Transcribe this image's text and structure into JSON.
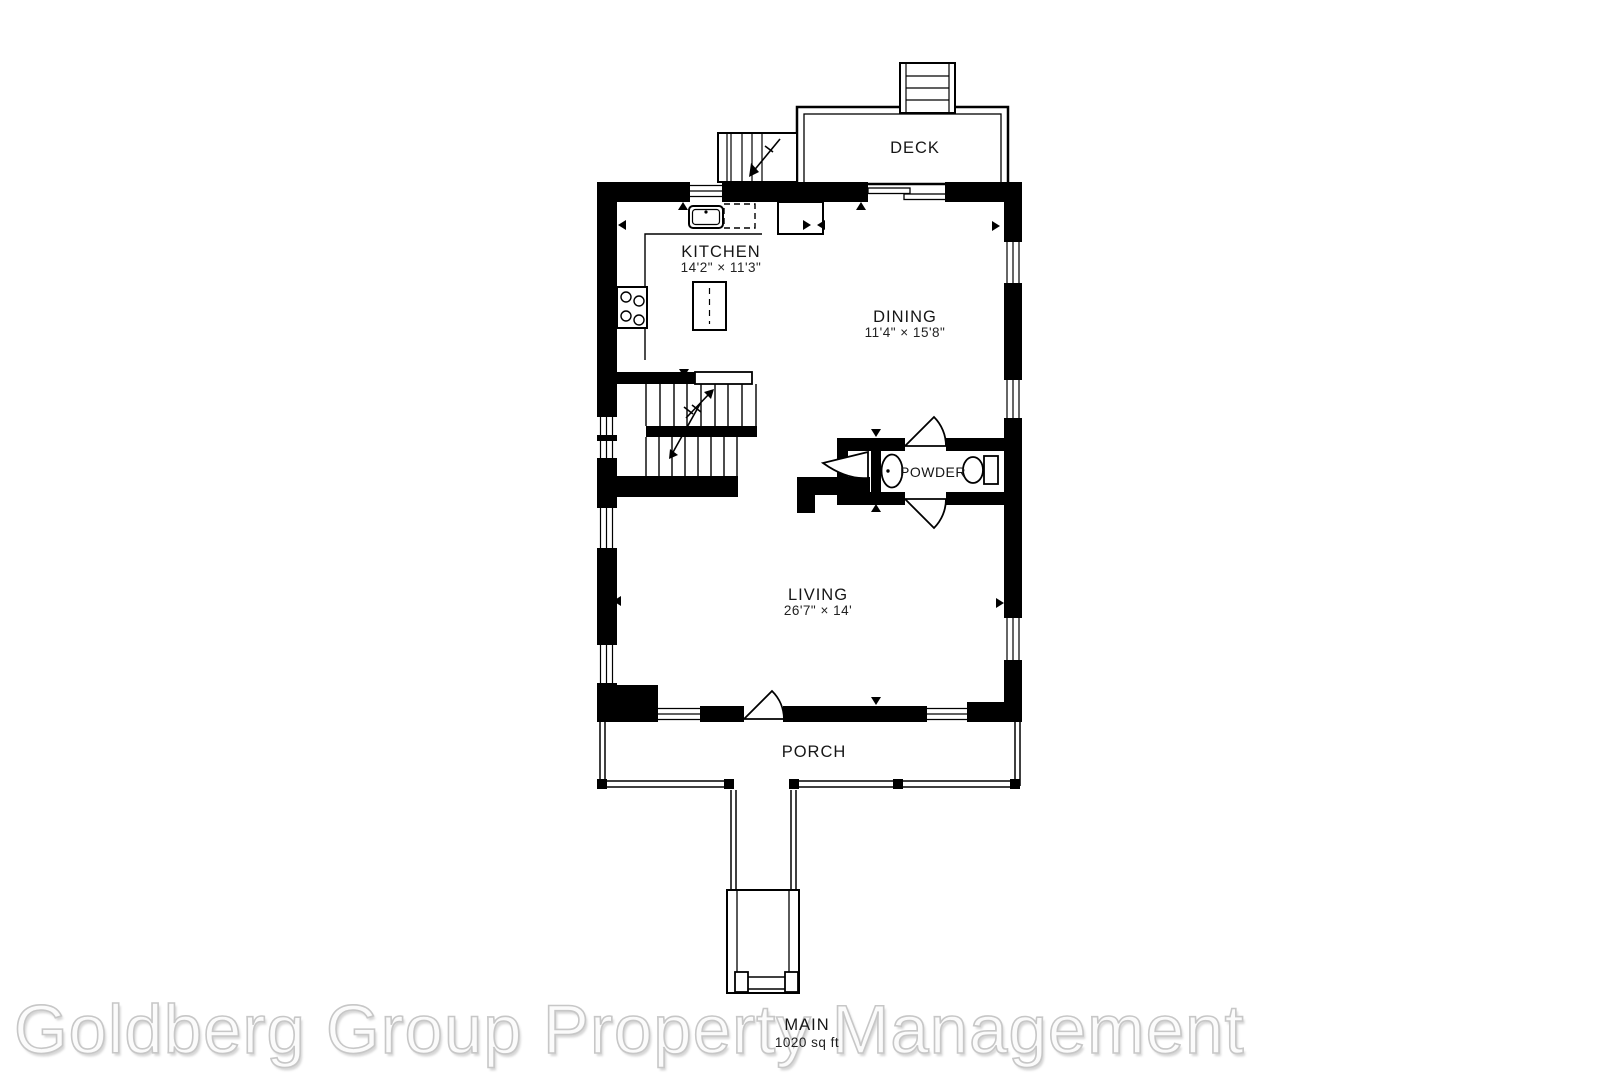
{
  "watermark": {
    "text": "Goldberg Group Property Management",
    "color": "#fbfbfb",
    "outline_color": "#c7c7c7"
  },
  "floorplan": {
    "wall_color": "#000000",
    "label_color": "#161616",
    "level": {
      "name": "MAIN",
      "area": "1020 sq ft"
    },
    "rooms": {
      "deck": {
        "label": "DECK"
      },
      "kitchen": {
        "label": "KITCHEN",
        "dims": "14'2\" × 11'3\""
      },
      "dining": {
        "label": "DINING",
        "dims": "11'4\" × 15'8\""
      },
      "powder": {
        "label": "POWDER"
      },
      "living": {
        "label": "LIVING",
        "dims": "26'7\" × 14'"
      },
      "porch": {
        "label": "PORCH"
      }
    }
  }
}
